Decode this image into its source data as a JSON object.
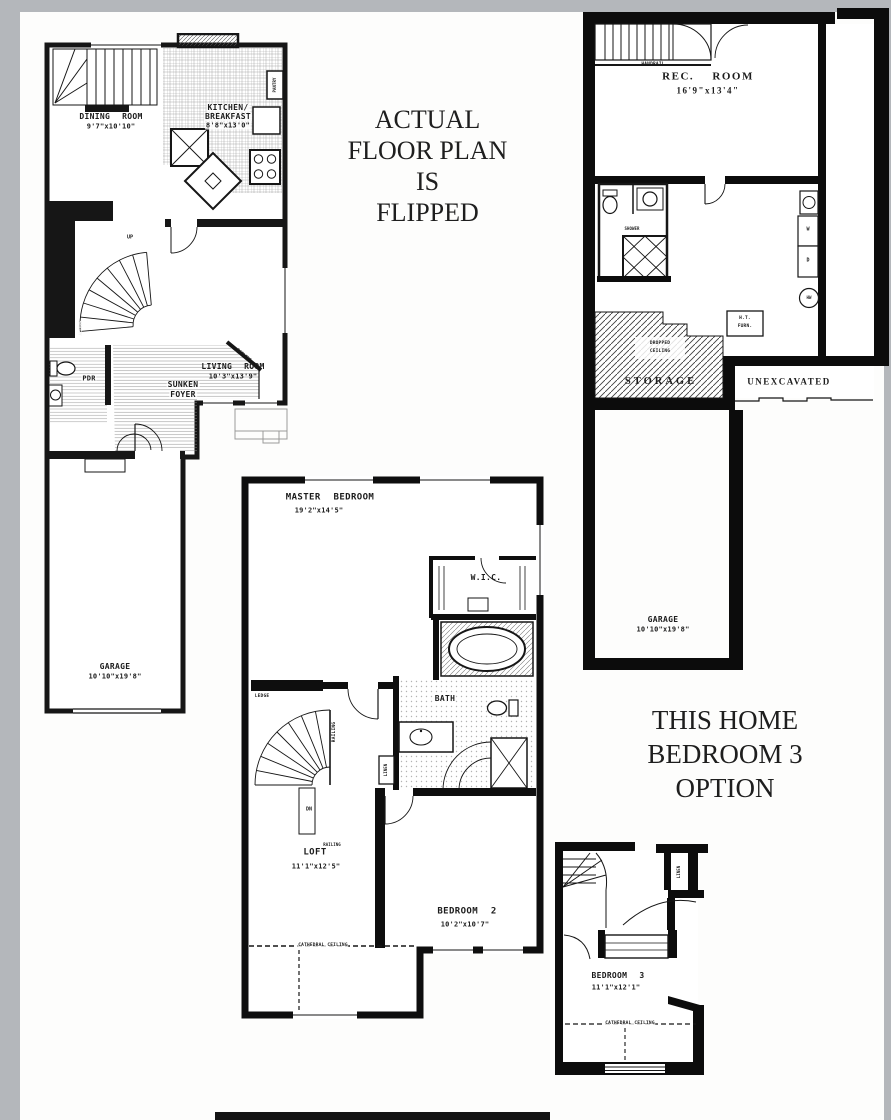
{
  "colors": {
    "ink": "#161616",
    "paper": "#fdfdfc",
    "scan_border": "#b4b7bb"
  },
  "annotations": {
    "flipped": {
      "l1": "ACTUAL",
      "l2": "FLOOR PLAN",
      "l3": "IS",
      "l4": "FLIPPED"
    },
    "option": {
      "l1": "THIS HOME",
      "l2": "BEDROOM 3",
      "l3": "OPTION"
    }
  },
  "first_floor": {
    "dining": {
      "name": "DINING ROOM",
      "dims": "9'7\"x10'10\""
    },
    "kitchen": {
      "name": "KITCHEN/",
      "name2": "BREAKFAST",
      "dims": "8'8\"x13'0\""
    },
    "pantry": "PANTRY",
    "living": {
      "name": "LIVING ROOM",
      "dims": "10'3\"x13'9\""
    },
    "foyer": {
      "l1": "SUNKEN",
      "l2": "FOYER"
    },
    "pdr": "PDR",
    "up": "UP",
    "alcove": "ALCOVE",
    "railing": "RAILING",
    "garage": {
      "name": "GARAGE",
      "dims": "10'10\"x19'8\""
    }
  },
  "basement": {
    "handrail": "HANDRAIL",
    "rec_room": {
      "name": "REC. ROOM",
      "dims": "16'9\"x13'4\""
    },
    "shower": "SHOWER",
    "washer": "W",
    "dryer": "D",
    "water_heater": "HW",
    "furnace": {
      "l1": "H.T.",
      "l2": "FURN."
    },
    "dropped_ceiling": {
      "l1": "DROPPED",
      "l2": "CEILING"
    },
    "storage": "STORAGE",
    "unexcavated": "UNEXCAVATED",
    "garage": {
      "name": "GARAGE",
      "dims": "10'10\"x19'8\""
    }
  },
  "second_floor": {
    "master": {
      "name": "MASTER BEDROOM",
      "dims": "19'2\"x14'5\""
    },
    "wic": "W.I.C.",
    "bath": "BATH",
    "linen": "LINEN",
    "ledge": "LEDGE",
    "railing_vertical": "RAILING",
    "railing_small": "RAILING",
    "dn": "DN",
    "loft": {
      "name": "LOFT",
      "dims": "11'1\"x12'5\""
    },
    "bedroom2": {
      "name": "BEDROOM 2",
      "dims": "10'2\"x10'7\""
    },
    "cathedral_ceiling": "CATHEDRAL CEILING"
  },
  "bedroom3_option": {
    "linen": "LINEN",
    "bedroom3": {
      "name": "BEDROOM 3",
      "dims": "11'1\"x12'1\""
    },
    "cathedral_ceiling": "CATHEDRAL CEILING"
  }
}
